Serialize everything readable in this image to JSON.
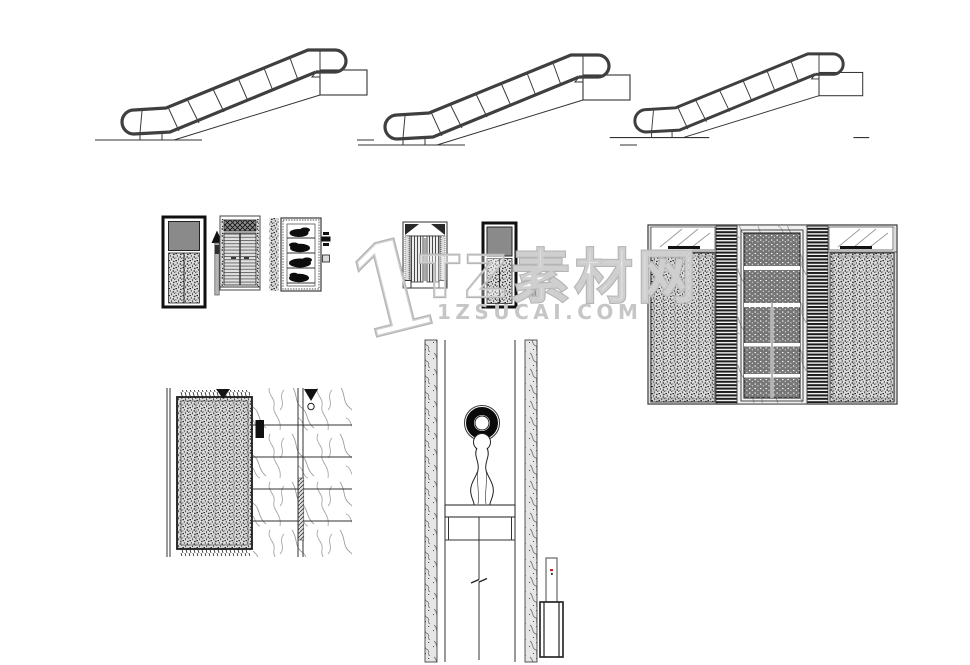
{
  "watermark": {
    "numeral": "1",
    "brand": "TZ素材网",
    "domain": "1ZSUCAI.COM"
  },
  "colors": {
    "bg": "#ffffff",
    "ink": "#1c1c1c",
    "line-gray": "#555555",
    "panel-gray": "#8a8a8a",
    "wm-outline": "#b5b5b5",
    "wm-text": "#c6c6c6",
    "accent-red": "#b03030"
  },
  "drawing": {
    "escalator_count": 3,
    "components": [
      "escalator-side-elevation-1",
      "escalator-side-elevation-2",
      "escalator-side-elevation-3",
      "elevator-call-panel-left",
      "direction-post-left",
      "elevator-door-louver",
      "plant-display-cabinet",
      "legend-glyphs",
      "ornate-elevator-door",
      "elevator-call-panel-right",
      "direction-post-right",
      "elevator-lobby-elevation",
      "elevator-door-plan",
      "corridor-plan-with-vase",
      "pedestal-detail"
    ]
  }
}
